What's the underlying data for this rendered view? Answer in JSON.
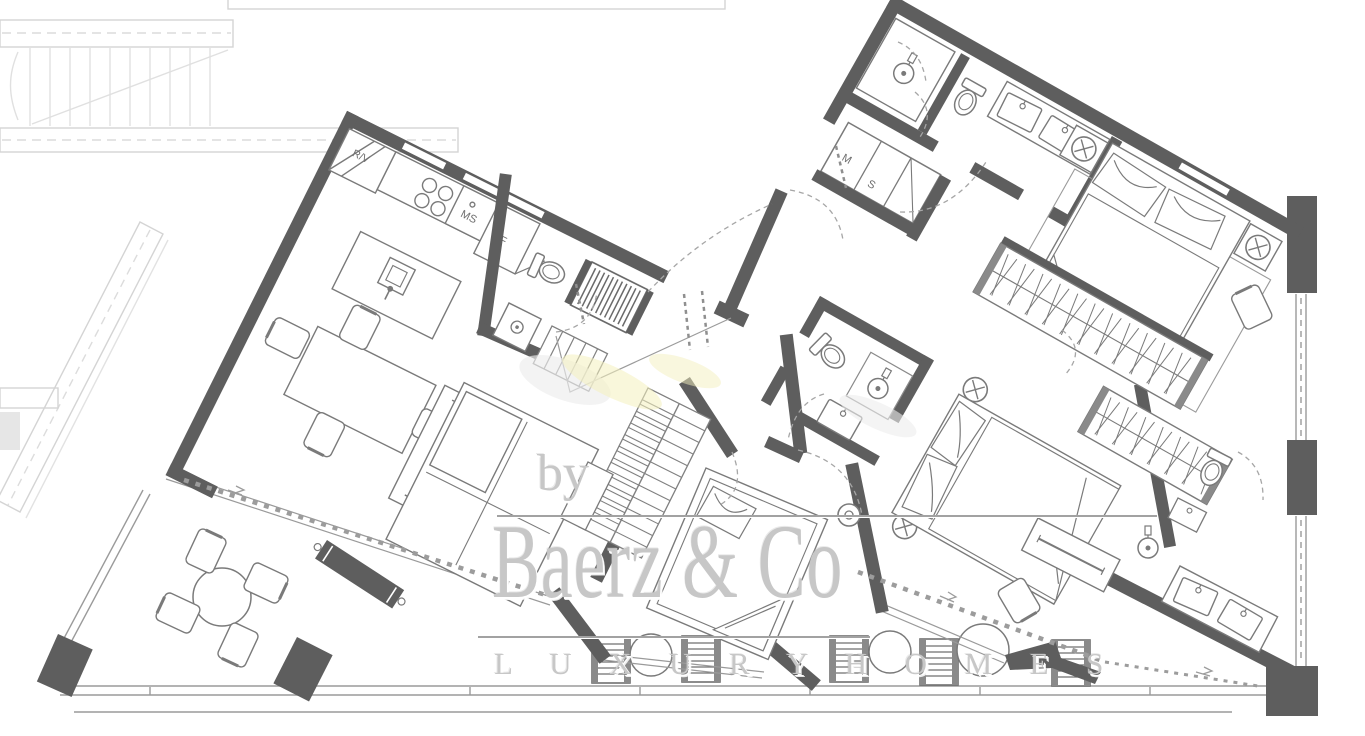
{
  "plan": {
    "appliance_labels": {
      "corner_unit": "R/V",
      "sink_unit": "MS",
      "fridge": "F",
      "washer": "M",
      "dryer": "S"
    },
    "watermark": {
      "prefix": "by",
      "brand": "Baerz & Co",
      "tagline": "L U X U R Y   H O M E S"
    },
    "colors": {
      "wall": "#5e5e5e",
      "furniture_line": "#7a7a7a",
      "light_structure": "#d6d6d6",
      "watermark_text": "#c7c7c7",
      "smudge": "#f4f0bd",
      "background": "#ffffff"
    }
  }
}
